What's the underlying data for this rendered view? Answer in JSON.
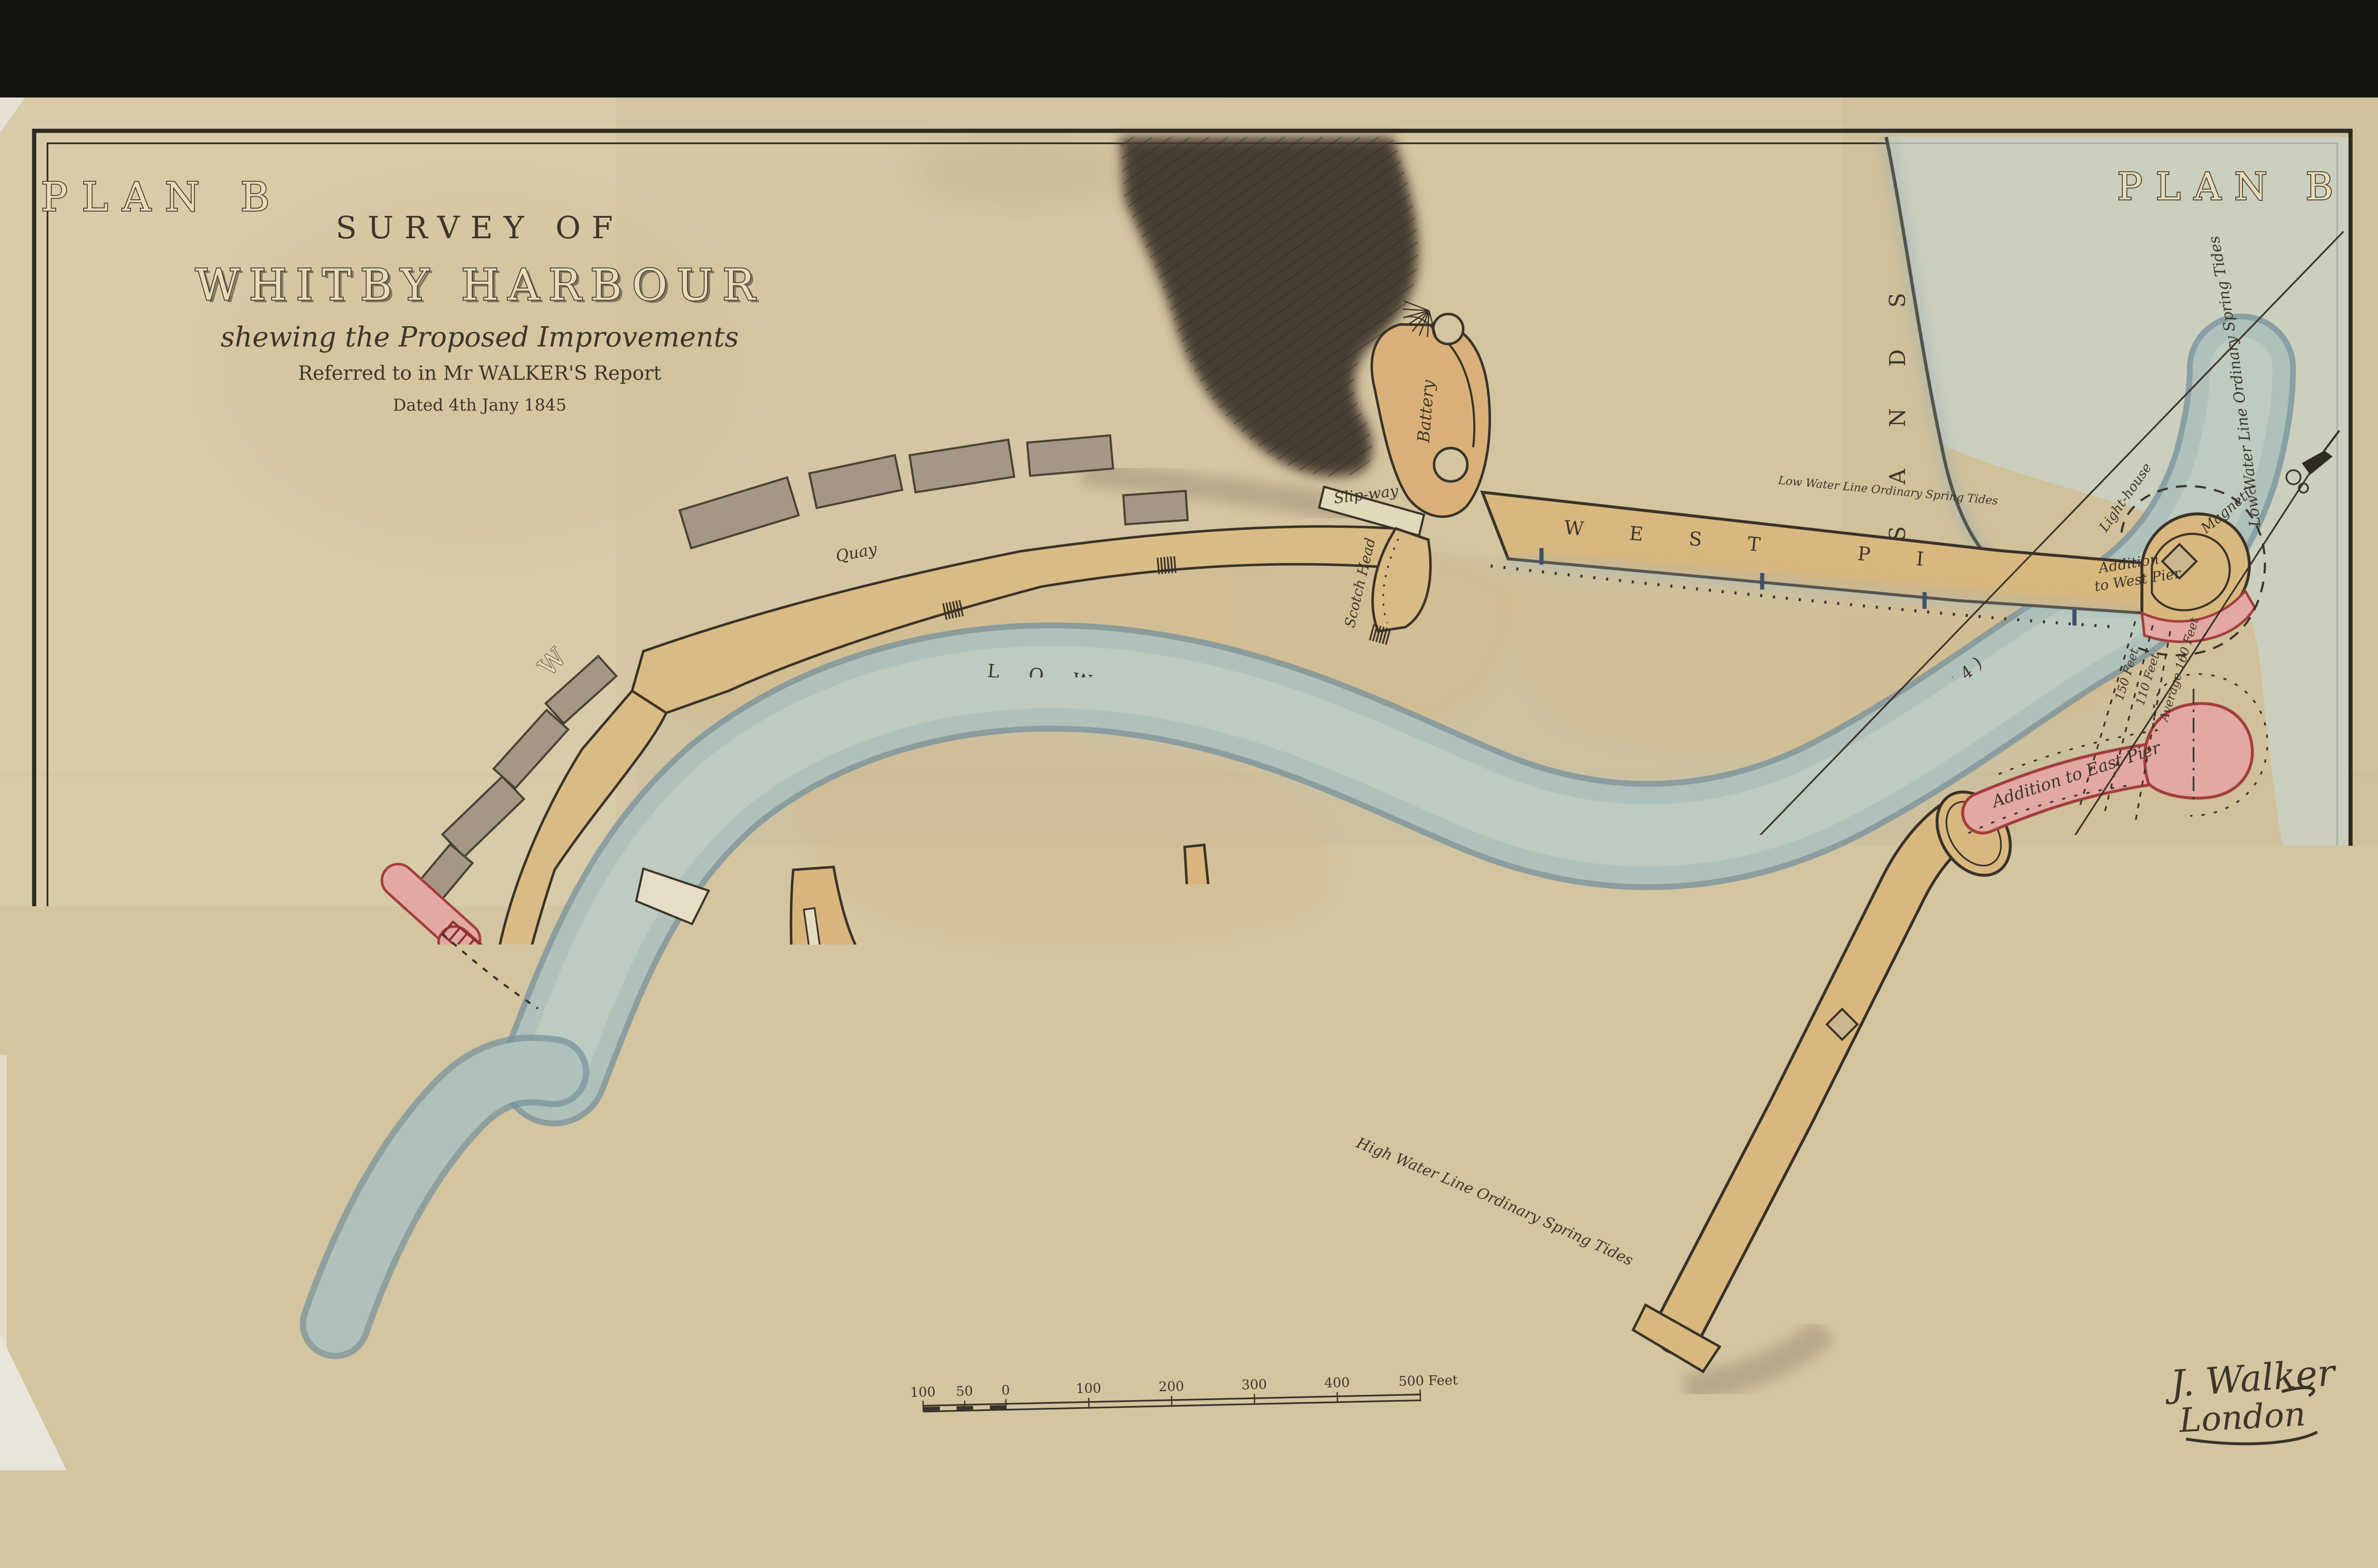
{
  "plan_label": "PLAN B",
  "title": {
    "line1": "SURVEY OF",
    "line2": "WHITBY HARBOUR",
    "line3": "shewing the Proposed Improvements",
    "line4": "Referred to in Mr WALKER'S Report",
    "line5": "Dated 4th Jany 1845"
  },
  "labels": {
    "town_west": "TOWN OF WHITBY",
    "town_south": "TOWN OF WHITBY",
    "inner_harbour": "INNER HARBOUR",
    "outer": "OUTER",
    "harbour": "HARBOUR",
    "low_water_channel": "LOW WATER CHANNEL",
    "channel_date": "(Octr 1844)",
    "west_pier": "WEST PIER",
    "east_pier": "EAST PIER",
    "collier_hope": "COLLIER HOPE",
    "sands": "SANDS",
    "the_scar": "THE SCAR",
    "battery": "Battery",
    "slip_way": "Slip-way",
    "quay": "Quay",
    "scotch_head": "Scotch Head",
    "st_anns_staith": "St Ann's Staith",
    "fish_pier": "Fish Pier",
    "bridge": "Bridge",
    "sluices": "Sluices",
    "gates": "Gates",
    "addition_west_1": "Addition",
    "addition_west_2": "to West Pier",
    "addition_east": "Addition to East Pier",
    "lighthouse": "Light-house",
    "magnetic": "Magnetic",
    "high_water_line": "High Water Line Ordinary Spring Tides",
    "low_water_line_coast": "Low Water Line Ordinary Spring Tides",
    "low_water_line_pier": "Low Water Line Ordinary Spring Tides",
    "width_1": "150 Feet",
    "width_2": "110 Feet",
    "width_3": "Average 160 Feet"
  },
  "scale_bar": {
    "ticks": [
      "100",
      "50",
      "0",
      "100",
      "200",
      "300",
      "400"
    ],
    "end_label": "500 Feet"
  },
  "signature": {
    "name": "J. Walker",
    "place": "London"
  },
  "colors": {
    "paper": "#d3c5a0",
    "water": "#aec1ba",
    "water_edge": "#74909d",
    "sand": "#d9b87f",
    "proposed_pink": "#e2a8a4",
    "proposed_red": "#a33d3c",
    "ink": "#3a3227",
    "sea": "#c9d2c5",
    "building_grey": "#a59786",
    "cliff_dark": "#4a3e31"
  }
}
